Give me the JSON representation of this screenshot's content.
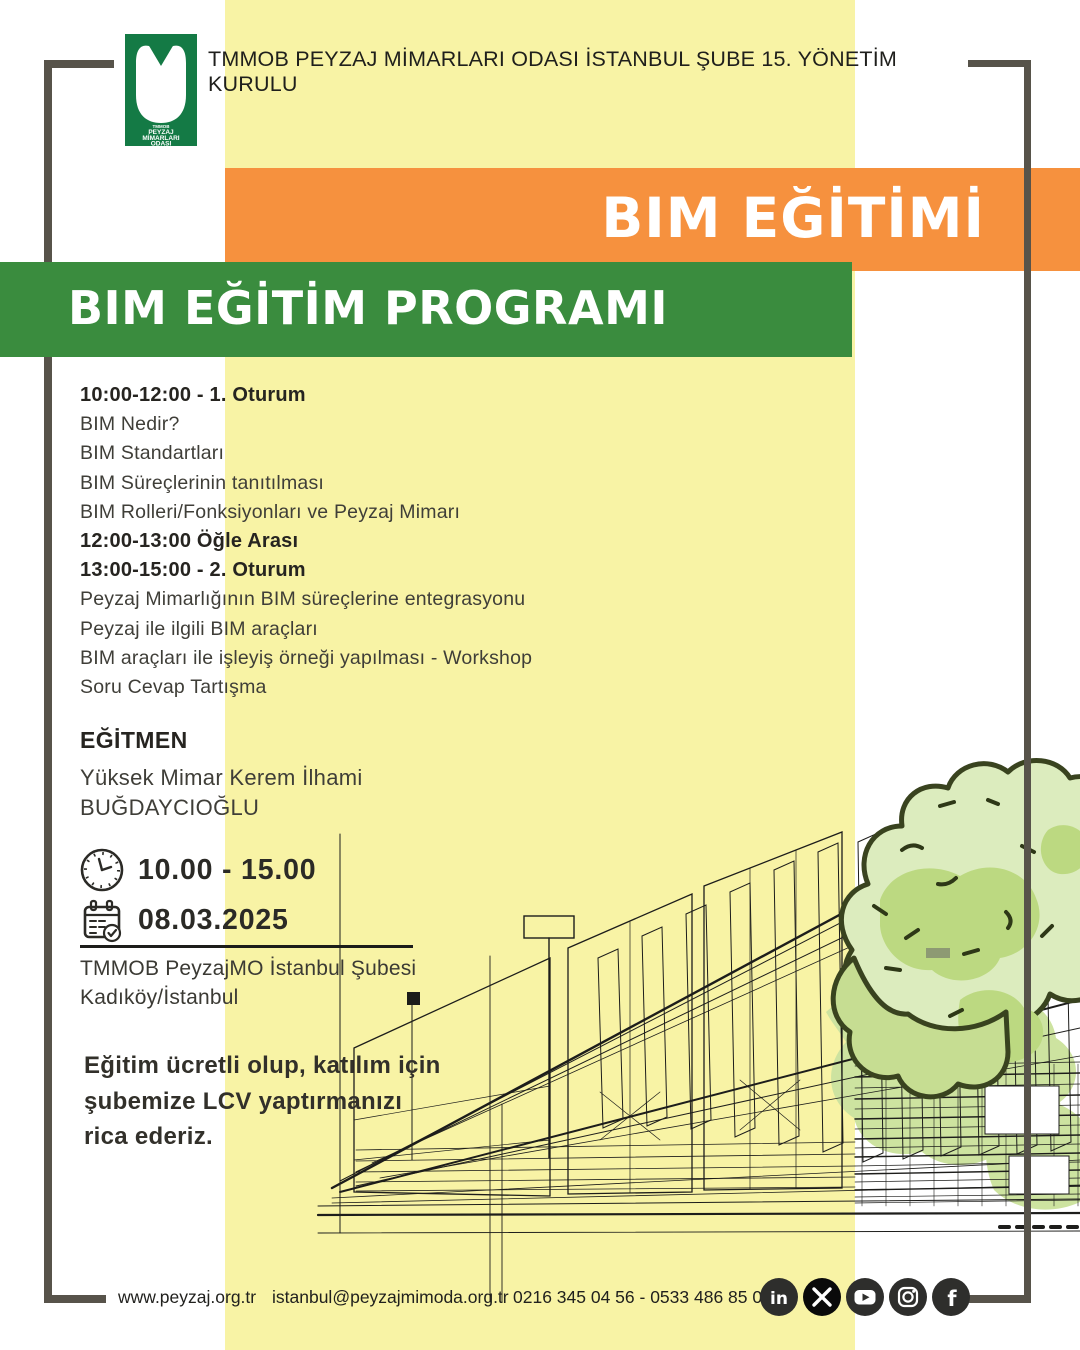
{
  "header": {
    "org_title": "TMMOB PEYZAJ MİMARLARI ODASI İSTANBUL ŞUBE 15. YÖNETİM KURULU",
    "logo": {
      "top_small": "TMMOB",
      "line1": "PEYZAJ",
      "line2": "MİMARLARI",
      "line3": "ODASI"
    }
  },
  "banners": {
    "main_title": "BIM EĞİTİMİ",
    "subtitle": "BIM EĞİTİM PROGRAMI"
  },
  "program": {
    "items": [
      {
        "text": "10:00-12:00 - 1. Oturum",
        "bold": true
      },
      {
        "text": "BIM Nedir?",
        "bold": false
      },
      {
        "text": "BIM Standartları",
        "bold": false
      },
      {
        "text": "BIM Süreçlerinin tanıtılması",
        "bold": false
      },
      {
        "text": "BIM Rolleri/Fonksiyonları ve Peyzaj Mimarı",
        "bold": false
      },
      {
        "text": "12:00-13:00 Öğle Arası",
        "bold": true
      },
      {
        "text": "13:00-15:00 - 2. Oturum",
        "bold": true
      },
      {
        "text": "Peyzaj Mimarlığının BIM süreçlerine entegrasyonu",
        "bold": false
      },
      {
        "text": "Peyzaj ile ilgili BIM araçları",
        "bold": false
      },
      {
        "text": "BIM araçları ile işleyiş örneği yapılması - Workshop",
        "bold": false
      },
      {
        "text": "Soru Cevap Tartışma",
        "bold": false
      }
    ]
  },
  "instructor": {
    "heading": "EĞİTMEN",
    "name_line1": "Yüksek Mimar Kerem İlhami",
    "name_line2": "BUĞDAYCIOĞLU"
  },
  "event": {
    "time": "10.00 - 15.00",
    "date": "08.03.2025",
    "venue_line1": "TMMOB PeyzajMO İstanbul Şubesi",
    "venue_line2": "Kadıköy/İstanbul"
  },
  "notice": {
    "line1": "Eğitim ücretli olup, katılım için",
    "line2": "şubemize LCV yaptırmanızı",
    "line3": "rica ederiz."
  },
  "footer": {
    "website": "www.peyzaj.org.tr",
    "email": "istanbul@peyzajmimoda.org.tr",
    "phones": "0216 345 04 56 - 0533 486 85 00",
    "social": [
      {
        "name": "linkedin",
        "label": "LinkedIn"
      },
      {
        "name": "x",
        "label": "X"
      },
      {
        "name": "youtube",
        "label": "YouTube"
      },
      {
        "name": "instagram",
        "label": "Instagram"
      },
      {
        "name": "facebook",
        "label": "Facebook"
      }
    ]
  },
  "colors": {
    "yellow_column": "#f8f3a5",
    "orange_banner": "#f6913e",
    "green_banner": "#3a8c3e",
    "logo_green": "#147a45",
    "frame_gray": "#57534a",
    "text_dark": "#2b2a26",
    "tree_light_green": "#dcecbe",
    "tree_mid_green": "#bcd981",
    "sketch_ink": "#1d1d1b"
  }
}
